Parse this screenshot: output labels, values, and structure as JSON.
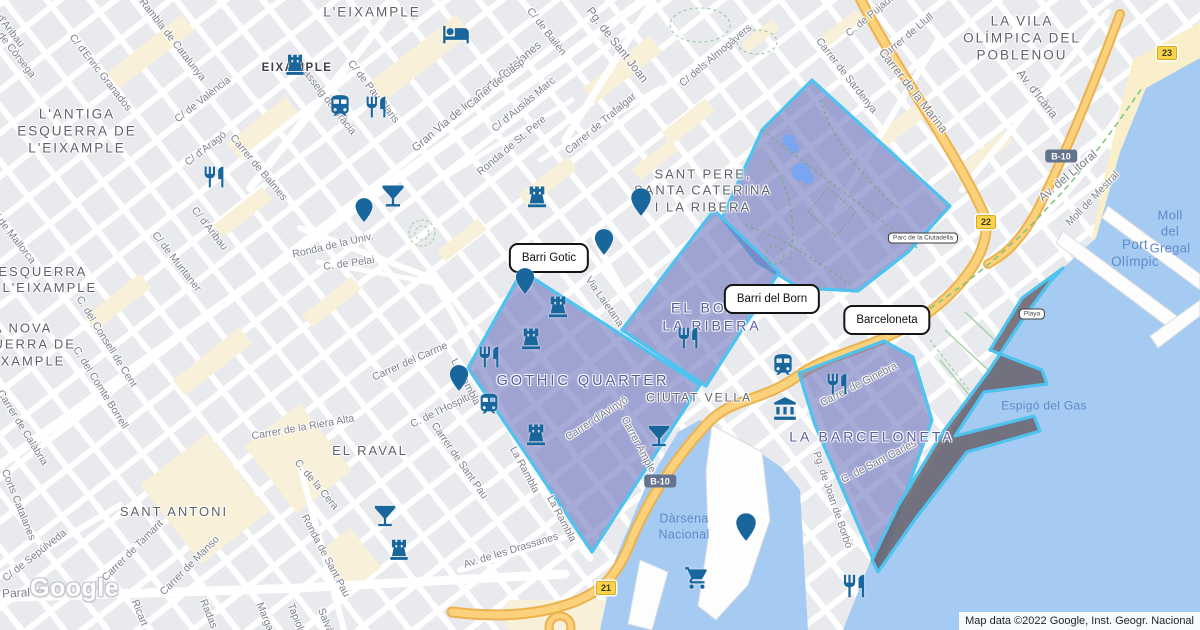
{
  "map": {
    "watermark": "Google",
    "attribution": "Map data ©2022 Google, Inst. Geogr. Nacional",
    "colors": {
      "region_fill": "rgba(113,119,190,0.62)",
      "region_border": "#4ec3f0",
      "beach_fill": "rgba(106,100,112,0.88)",
      "water": "#a6cbf2",
      "sand": "#f9f0cb",
      "road_yellow": "#fbd27b",
      "road_yellow_casing": "#ecb24f",
      "icon_blue": "#19669c",
      "district_label": "#585d9e",
      "area_label": "#5f6268",
      "street_label": "#7d818b",
      "water_label": "#5d8bc7"
    },
    "callouts": [
      {
        "label": "Barri Gotic",
        "x": 549,
        "y": 258
      },
      {
        "label": "Barri del Born",
        "x": 772,
        "y": 299
      },
      {
        "label": "Barceloneta",
        "x": 887,
        "y": 320
      }
    ],
    "regions": [
      {
        "name": "parc-de-la-ciutadella",
        "kind": "district",
        "pts": "812,80 950,206 908,252 858,291 800,288 757,262 722,218 762,130"
      },
      {
        "name": "el-born-la-ribera",
        "kind": "district",
        "pts": "714,210 779,272 706,386 622,330"
      },
      {
        "name": "gothic-quarter",
        "kind": "district",
        "pts": "522,271 700,385 592,552 468,368"
      },
      {
        "name": "la-barceloneta",
        "kind": "district",
        "pts": "799,373 884,341 913,357 932,420 878,571 815,425"
      },
      {
        "name": "barceloneta-beach",
        "kind": "beach",
        "pts": "1063,268 1022,298 990,350 1042,370 1047,384 984,392 955,436 1034,416 1040,431 967,452 916,518 878,572 872,560 898,506 943,432 988,372 1025,316 1050,282"
      }
    ],
    "district_labels": [
      {
        "t": "GOTHIC QUARTER",
        "x": 583,
        "y": 381,
        "fs": 14.5
      },
      {
        "t": "EL BORN\nLA RIBERA",
        "x": 712,
        "y": 317,
        "fs": 14
      },
      {
        "t": "LA BARCELONETA",
        "x": 872,
        "y": 437,
        "fs": 14
      }
    ],
    "area_labels": [
      {
        "t": "L'EIXAMPLE",
        "x": 372,
        "y": 13,
        "fs": 13.5
      },
      {
        "t": "EIXAMPLE",
        "x": 297,
        "y": 68,
        "fs": 11.5,
        "dark": true
      },
      {
        "t": "L'ANTIGA\nESQUERRA DE\nL'EIXAMPLE",
        "x": 77,
        "y": 132,
        "fs": 13.5
      },
      {
        "t": "L'ESQUERRA\nDE L'EIXAMPLE",
        "x": 36,
        "y": 280,
        "fs": 13
      },
      {
        "t": "LA NOVA\nESQUERRA DE\nL'EIXAMPLE",
        "x": 18,
        "y": 345,
        "fs": 13
      },
      {
        "t": "SANT PERE,\nSANTA CATERINA\nI LA RIBERA",
        "x": 703,
        "y": 191,
        "fs": 13
      },
      {
        "t": "LA VILA\nOLÍMPICA DEL\nPOBLENOU",
        "x": 1022,
        "y": 39,
        "fs": 13.5
      },
      {
        "t": "CIUTAT VELLA",
        "x": 699,
        "y": 398,
        "fs": 12
      },
      {
        "t": "EL RAVAL",
        "x": 370,
        "y": 451,
        "fs": 13
      },
      {
        "t": "SANT ANTONI",
        "x": 174,
        "y": 512,
        "fs": 13
      }
    ],
    "street_labels": [
      {
        "t": "C. de Còrsega",
        "x": 12,
        "y": 50,
        "r": 52
      },
      {
        "t": "C/ d'Aribau",
        "x": 6,
        "y": 26,
        "r": 52
      },
      {
        "t": "C/ d'Enric Granados",
        "x": 100,
        "y": 73,
        "r": 52
      },
      {
        "t": "Rambla de Catalunya",
        "x": 172,
        "y": 40,
        "r": 52
      },
      {
        "t": "C/ de València",
        "x": 203,
        "y": 100,
        "r": -38
      },
      {
        "t": "C/ d'Aragó",
        "x": 206,
        "y": 149,
        "r": -38
      },
      {
        "t": "Carrer de Balmes",
        "x": 258,
        "y": 168,
        "r": 50
      },
      {
        "t": "Passeig de Gràcia",
        "x": 327,
        "y": 100,
        "r": 52
      },
      {
        "t": "C/ de Pau Claris",
        "x": 373,
        "y": 92,
        "r": 52
      },
      {
        "t": "Gran Via de les Corts Catalanes",
        "x": 477,
        "y": 97,
        "r": -40,
        "fs": 11.5
      },
      {
        "t": "Carrer de Casp",
        "x": 496,
        "y": 84,
        "r": -40
      },
      {
        "t": "C/ d'Ausiàs Marc",
        "x": 524,
        "y": 105,
        "r": -40
      },
      {
        "t": "Ronda de St. Pere",
        "x": 512,
        "y": 146,
        "r": -40
      },
      {
        "t": "Carrer de Trafalgar",
        "x": 601,
        "y": 124,
        "r": -40
      },
      {
        "t": "C/ de Bailèn",
        "x": 546,
        "y": 32,
        "r": 52
      },
      {
        "t": "Pg. de Sant Joan",
        "x": 617,
        "y": 45,
        "r": 52,
        "fs": 12
      },
      {
        "t": "C/ dels Almogàvers",
        "x": 716,
        "y": 56,
        "r": -40
      },
      {
        "t": "C. de Pujades",
        "x": 873,
        "y": 14,
        "r": -40
      },
      {
        "t": "Carrer de Llull",
        "x": 907,
        "y": 37,
        "r": -40
      },
      {
        "t": "Carrer de Sardenya",
        "x": 846,
        "y": 76,
        "r": 52
      },
      {
        "t": "Carrer de la Marina",
        "x": 913,
        "y": 91,
        "r": 52,
        "fs": 12
      },
      {
        "t": "Av. d'Icària",
        "x": 1037,
        "y": 94,
        "r": 52,
        "fs": 12
      },
      {
        "t": "Av. del Litoral",
        "x": 1068,
        "y": 176,
        "r": -40,
        "fs": 12
      },
      {
        "t": "Moll de Mestral",
        "x": 1093,
        "y": 199,
        "r": -46
      },
      {
        "t": "Ronda de la Univ.",
        "x": 333,
        "y": 246,
        "r": -13
      },
      {
        "t": "C. de Pelai",
        "x": 349,
        "y": 264,
        "r": -8
      },
      {
        "t": "C/ de Mallorca",
        "x": 12,
        "y": 236,
        "r": 52
      },
      {
        "t": "C/ d'Aribau",
        "x": 209,
        "y": 229,
        "r": 52
      },
      {
        "t": "C/ de Muntaner",
        "x": 176,
        "y": 262,
        "r": 52
      },
      {
        "t": "C. del Consell de Cent",
        "x": 106,
        "y": 342,
        "r": 58
      },
      {
        "t": "C. del Comte Borrell",
        "x": 100,
        "y": 388,
        "r": 58
      },
      {
        "t": "Carrer de Calàbria",
        "x": 22,
        "y": 428,
        "r": 58
      },
      {
        "t": "Carrer del Carme",
        "x": 410,
        "y": 362,
        "r": -24
      },
      {
        "t": "C. de l'Hospital",
        "x": 443,
        "y": 410,
        "r": -26
      },
      {
        "t": "La Rambla",
        "x": 465,
        "y": 382,
        "r": 62
      },
      {
        "t": "La Rambla",
        "x": 524,
        "y": 470,
        "r": 62
      },
      {
        "t": "La Rambla",
        "x": 561,
        "y": 519,
        "r": 62
      },
      {
        "t": "Carrer de Sant Pau",
        "x": 459,
        "y": 461,
        "r": 55
      },
      {
        "t": "Av. de les Drassanes",
        "x": 511,
        "y": 551,
        "r": -17
      },
      {
        "t": "Via Laietana",
        "x": 604,
        "y": 302,
        "r": 55
      },
      {
        "t": "Carrer d'Avinyó",
        "x": 597,
        "y": 419,
        "r": -33
      },
      {
        "t": "Carrer Ample",
        "x": 638,
        "y": 445,
        "r": 62
      },
      {
        "t": "Carrer de la Riera Alta",
        "x": 303,
        "y": 428,
        "r": -10
      },
      {
        "t": "C. de la Cera",
        "x": 316,
        "y": 485,
        "r": 50
      },
      {
        "t": "Ronda de Sant Pau",
        "x": 325,
        "y": 556,
        "r": 62
      },
      {
        "t": "Carrer de Tamarit",
        "x": 133,
        "y": 551,
        "r": -45
      },
      {
        "t": "Carrer de Manso",
        "x": 190,
        "y": 566,
        "r": -45
      },
      {
        "t": "C/ de Sepúlveda",
        "x": 35,
        "y": 556,
        "r": -38
      },
      {
        "t": "Corts Catalanes",
        "x": 18,
        "y": 505,
        "r": 68
      },
      {
        "t": "Paral·lel",
        "x": 24,
        "y": 593,
        "r": -3,
        "fs": 12
      },
      {
        "t": "Ricart",
        "x": 139,
        "y": 613,
        "r": 68
      },
      {
        "t": "Radas",
        "x": 208,
        "y": 614,
        "r": 68
      },
      {
        "t": "Margarit",
        "x": 266,
        "y": 621,
        "r": 68
      },
      {
        "t": "Tapioles",
        "x": 297,
        "y": 622,
        "r": 68
      },
      {
        "t": "Salvà",
        "x": 325,
        "y": 621,
        "r": 68
      },
      {
        "t": "C. de Sant Carles",
        "x": 879,
        "y": 462,
        "r": -27
      },
      {
        "t": "Pg. de Joan de Borbó",
        "x": 832,
        "y": 500,
        "r": 71
      },
      {
        "t": "Carrer de Ginebra",
        "x": 859,
        "y": 385,
        "r": -27
      }
    ],
    "water_labels": [
      {
        "t": "Port Olímpic",
        "x": 1135,
        "y": 254,
        "fs": 13.5
      },
      {
        "t": "Moll del\nGregal",
        "x": 1170,
        "y": 232,
        "fs": 13
      },
      {
        "t": "Espigó del Gas",
        "x": 1044,
        "y": 406,
        "fs": 12
      },
      {
        "t": "Dàrsena\nNacional",
        "x": 684,
        "y": 527,
        "fs": 12.5
      }
    ],
    "box_labels": [
      {
        "t": "Parc de la Ciutadella",
        "x": 923,
        "y": 238
      },
      {
        "t": "Playa",
        "x": 1032,
        "y": 314
      }
    ],
    "badges": [
      {
        "t": "B-10",
        "k": "blue",
        "x": 1061,
        "y": 156
      },
      {
        "t": "B-10",
        "k": "blue",
        "x": 660,
        "y": 481
      },
      {
        "t": "21",
        "k": "yellow",
        "x": 606,
        "y": 588
      },
      {
        "t": "22",
        "k": "yellow",
        "x": 986,
        "y": 222
      },
      {
        "t": "23",
        "k": "yellow",
        "x": 1167,
        "y": 53
      }
    ],
    "icons": [
      {
        "k": "castle",
        "x": 295,
        "y": 64,
        "s": 26
      },
      {
        "k": "castle",
        "x": 537,
        "y": 196,
        "s": 27
      },
      {
        "k": "castle",
        "x": 558,
        "y": 306,
        "s": 27
      },
      {
        "k": "castle",
        "x": 531,
        "y": 338,
        "s": 27
      },
      {
        "k": "castle",
        "x": 536,
        "y": 434,
        "s": 27
      },
      {
        "k": "castle",
        "x": 399,
        "y": 549,
        "s": 26
      },
      {
        "k": "restaurant",
        "x": 376,
        "y": 107,
        "s": 25
      },
      {
        "k": "restaurant",
        "x": 214,
        "y": 177,
        "s": 25
      },
      {
        "k": "restaurant",
        "x": 489,
        "y": 357,
        "s": 25
      },
      {
        "k": "restaurant",
        "x": 688,
        "y": 338,
        "s": 25
      },
      {
        "k": "restaurant",
        "x": 837,
        "y": 384,
        "s": 25
      },
      {
        "k": "restaurant",
        "x": 854,
        "y": 586,
        "s": 27
      },
      {
        "k": "cocktail",
        "x": 393,
        "y": 196,
        "s": 28
      },
      {
        "k": "cocktail",
        "x": 659,
        "y": 436,
        "s": 27
      },
      {
        "k": "cocktail",
        "x": 385,
        "y": 516,
        "s": 27
      },
      {
        "k": "bed",
        "x": 456,
        "y": 34,
        "s": 28
      },
      {
        "k": "train",
        "x": 340,
        "y": 106,
        "s": 26
      },
      {
        "k": "train",
        "x": 489,
        "y": 404,
        "s": 25
      },
      {
        "k": "train",
        "x": 783,
        "y": 365,
        "s": 26
      },
      {
        "k": "museum",
        "x": 785,
        "y": 409,
        "s": 26
      },
      {
        "k": "cart",
        "x": 697,
        "y": 578,
        "s": 26
      },
      {
        "k": "pin",
        "x": 641,
        "y": 202,
        "s": 30
      },
      {
        "k": "pin",
        "x": 604,
        "y": 242,
        "s": 28
      },
      {
        "k": "pin",
        "x": 525,
        "y": 281,
        "s": 28
      },
      {
        "k": "pin",
        "x": 459,
        "y": 378,
        "s": 28
      },
      {
        "k": "pin",
        "x": 746,
        "y": 527,
        "s": 30
      },
      {
        "k": "pin",
        "x": 364,
        "y": 210,
        "s": 26
      }
    ]
  }
}
